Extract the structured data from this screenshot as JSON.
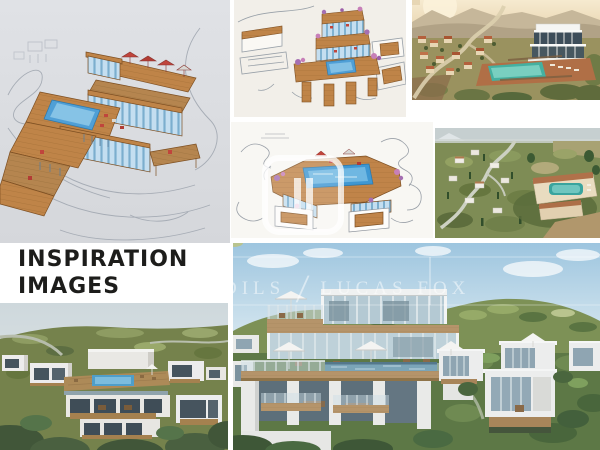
{
  "page": {
    "background_color": "#ffffff"
  },
  "title": {
    "line1": "INSPIRATION",
    "line2": "IMAGES",
    "color": "#1d1d1b"
  },
  "watermark": {
    "fragment_left": "DILS",
    "separator": "/",
    "brand": "LUCAS FOX",
    "color": "rgba(255,255,255,0.5)"
  },
  "palette": {
    "sketch_paper_gray": "#d9dbdf",
    "sketch_paper_warm": "#f2efe9",
    "sketch_wood": "#bf8448",
    "sketch_pool_blue": "#54a7dc",
    "sketch_glass_blue": "#c4def0",
    "illustration_sky_cream": "#f2e2c2",
    "illustration_pool_teal": "#4fb3a4",
    "photo_pool_teal": "#3aa49e",
    "render_sky_blue": "#9dc5df",
    "render_hill_green": "#5d7846",
    "render_deck_wood": "#b5946a",
    "render_pool_blue": "#7ba5b8",
    "render_wall_white": "#eceded"
  },
  "panels": [
    {
      "name": "hand-sketch-villa-large"
    },
    {
      "name": "hand-sketch-terraces"
    },
    {
      "name": "illustration-hillside-villa"
    },
    {
      "name": "hand-sketch-colored-pool-deck"
    },
    {
      "name": "aerial-photo-hillside"
    },
    {
      "name": "render-cube-villas"
    },
    {
      "name": "render-main-villa"
    }
  ]
}
